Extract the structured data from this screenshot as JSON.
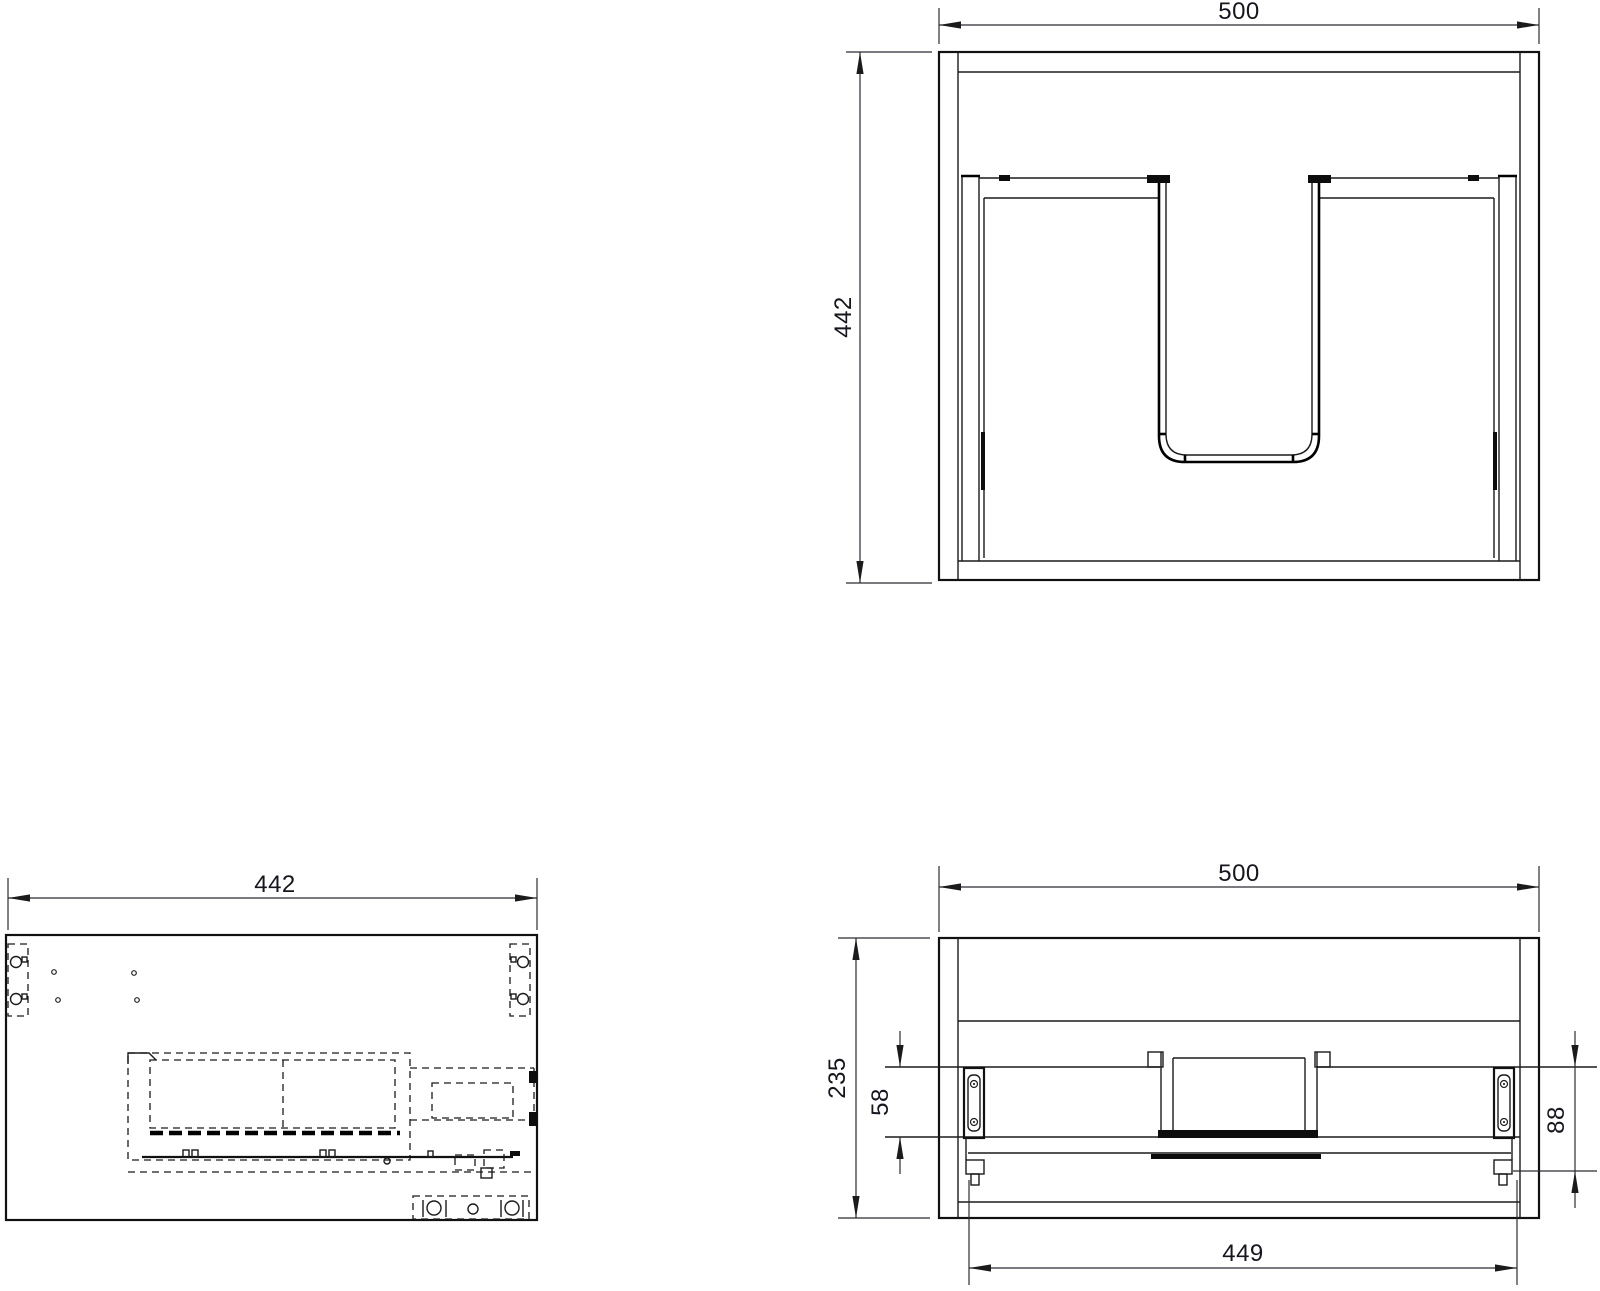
{
  "drawing": {
    "background_color": "#ffffff",
    "line_color": "#1b1b1b",
    "text_color": "#16161f",
    "views": {
      "front": {
        "title": "front-view-with-sink-cutout",
        "width_label": "500",
        "height_label": "442"
      },
      "plan": {
        "title": "top-view-hidden-lines",
        "width_label": "442"
      },
      "lower_front": {
        "title": "lower-front-section-view",
        "width_label": "500",
        "height_label": "235",
        "slide_offset_label": "58",
        "rail_height_label": "88",
        "inner_width_label": "449"
      }
    }
  }
}
